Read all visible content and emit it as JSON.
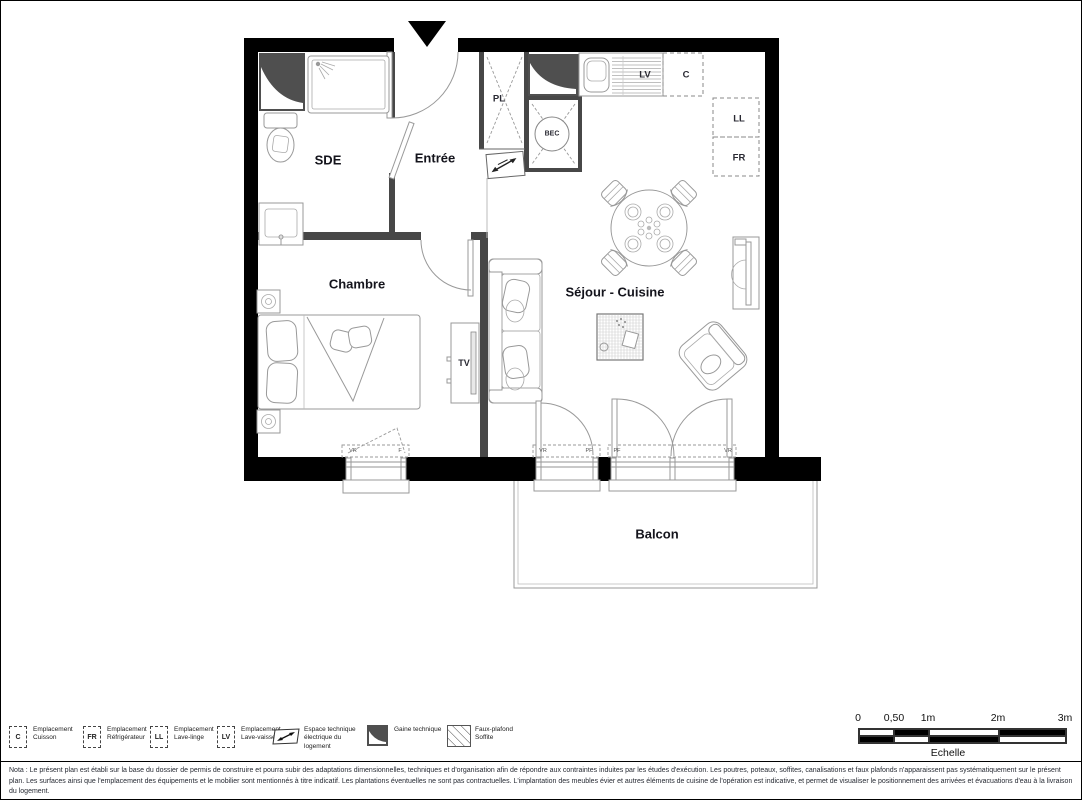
{
  "page": {
    "rooms": {
      "sde": "SDE",
      "entree": "Entrée",
      "chambre": "Chambre",
      "sejour_cuisine": "Séjour - Cuisine",
      "balcon": "Balcon"
    },
    "fixtures": {
      "pl": "PL",
      "bec": "BEC",
      "lv": "LV",
      "c": "C",
      "ll": "LL",
      "fr": "FR",
      "tv": "TV"
    },
    "windows": {
      "chambre": [
        "VR",
        "F"
      ],
      "sejour_left": [
        "VR",
        "PF"
      ],
      "sejour_right": [
        "PF",
        "VR"
      ]
    },
    "legend": {
      "items": [
        {
          "symbol": "C",
          "label": "Emplacement Cuisson",
          "type": "dashed-box"
        },
        {
          "symbol": "FR",
          "label": "Emplacement Réfrigérateur",
          "type": "dashed-box"
        },
        {
          "symbol": "LL",
          "label": "Emplacement Lave-linge",
          "type": "dashed-box"
        },
        {
          "symbol": "LV",
          "label": "Emplacement Lave-vaisselle",
          "type": "dashed-box"
        },
        {
          "symbol": "",
          "label": "Espace technique électrique du logement",
          "type": "electrical"
        },
        {
          "symbol": "",
          "label": "Gaine technique",
          "type": "duct"
        },
        {
          "symbol": "",
          "label": "Faux-plafond Soffite",
          "type": "soffit"
        }
      ]
    },
    "scale": {
      "ticks": [
        "0",
        "0,50",
        "1m",
        "2m",
        "3m"
      ],
      "label": "Echelle"
    },
    "nota": "Nota : Le présent plan est établi sur la base du dossier de permis de construire et pourra subir des adaptations dimensionnelles, techniques et d'organisation afin de répondre aux contraintes induites par les études d'exécution. Les poutres, poteaux, soffites, canalisations et faux plafonds n'apparaissent pas systématiquement sur le présent plan. Les surfaces ainsi que l'emplacement des équipements et le mobilier sont mentionnés à titre indicatif. Les plantations éventuelles ne sont pas contractuelles. L'implantation des meubles évier et autres éléments de cuisine de l'opération est indicative, et permet de visualiser le positionnement des arrivées et évacuations d'eau à la livraison du logement."
  },
  "colors": {
    "wall": "#000000",
    "partition": "#474747",
    "duct_fill": "#4f4f4f",
    "furniture_line": "#999999",
    "label_text": "#14141c"
  }
}
